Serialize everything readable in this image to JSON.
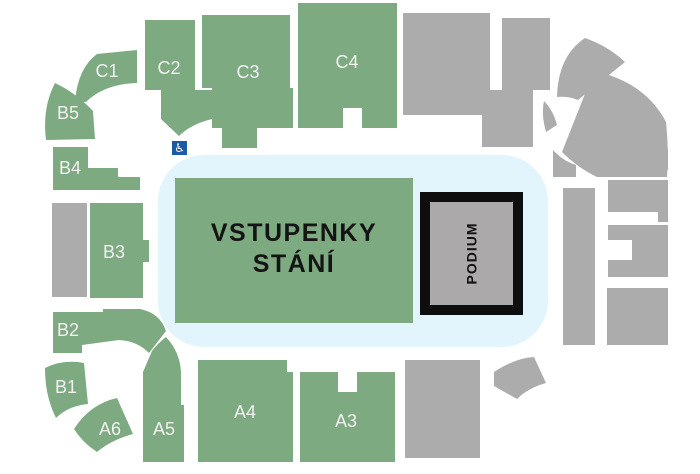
{
  "map": {
    "venue_type": "arena-seating-map",
    "colors": {
      "available_section": "#7daa80",
      "unavailable_section": "#adacad",
      "rink": "#e3f5fc",
      "section_label": "#f2f2f2",
      "standing_text": "#141414",
      "podium_fill": "#aba9aa",
      "podium_border": "#0e0e0e",
      "wheelchair_bg": "#1c5aa6",
      "background": "#ffffff"
    },
    "standing_area": {
      "label_line1": "VSTUPENKY",
      "label_line2": "STÁNÍ"
    },
    "podium": {
      "label": "PODIUM"
    },
    "wheelchair": {
      "icon": "wheelchair-accessible-icon"
    },
    "sections": [
      {
        "id": "C1",
        "label": "C1"
      },
      {
        "id": "C2",
        "label": "C2"
      },
      {
        "id": "C3",
        "label": "C3"
      },
      {
        "id": "C4",
        "label": "C4"
      },
      {
        "id": "B5",
        "label": "B5"
      },
      {
        "id": "B4",
        "label": "B4"
      },
      {
        "id": "B3",
        "label": "B3"
      },
      {
        "id": "B2",
        "label": "B2"
      },
      {
        "id": "B1",
        "label": "B1"
      },
      {
        "id": "A6",
        "label": "A6"
      },
      {
        "id": "A5",
        "label": "A5"
      },
      {
        "id": "A4",
        "label": "A4"
      },
      {
        "id": "A3",
        "label": "A3"
      }
    ]
  }
}
